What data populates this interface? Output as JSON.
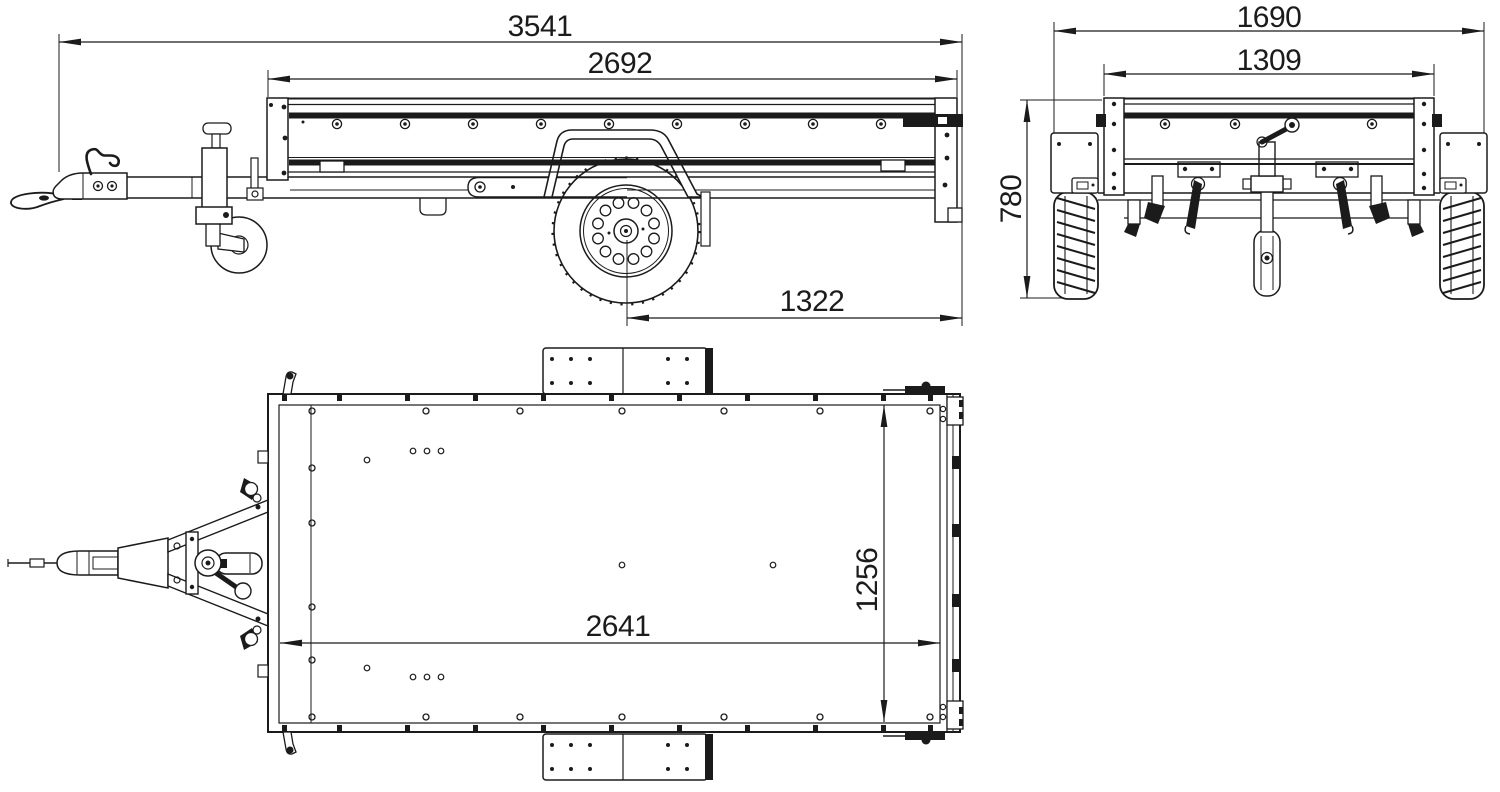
{
  "canvas": {
    "background": "#ffffff",
    "line_color": "#1b1b1b"
  },
  "views": {
    "side": {
      "dims": {
        "overall_length": "3541",
        "box_length": "2692",
        "axle_to_rear": "1322"
      }
    },
    "front": {
      "dims": {
        "overall_width": "1690",
        "box_width": "1309",
        "body_height": "780"
      }
    },
    "top": {
      "dims": {
        "inner_length": "2641",
        "inner_width": "1256"
      }
    }
  }
}
